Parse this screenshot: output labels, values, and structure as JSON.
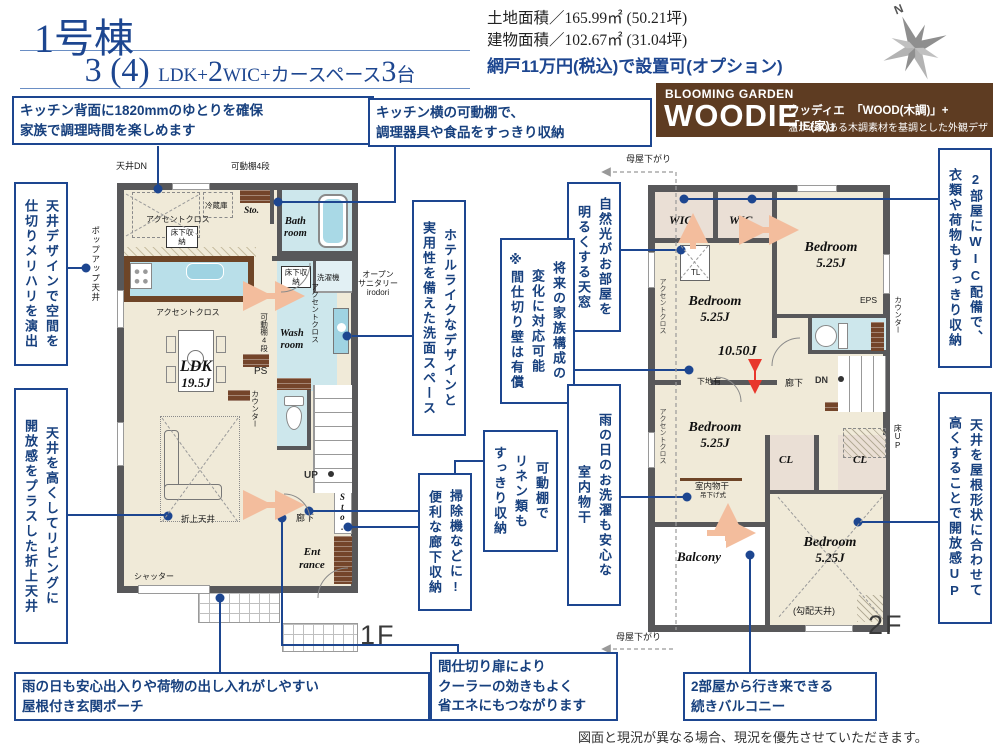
{
  "header": {
    "building_title": "1号棟",
    "layout_parts": [
      {
        "text": "3 (4) ",
        "size": "lg"
      },
      {
        "text": "LDK+",
        "size": "sm"
      },
      {
        "text": "2",
        "size": "lg"
      },
      {
        "text": "WIC+カースペース",
        "size": "sm"
      },
      {
        "text": "3",
        "size": "lg"
      },
      {
        "text": "台",
        "size": "sm"
      }
    ],
    "land_area": "土地面積／165.99㎡ (50.21坪)",
    "building_area": "建物面積／102.67㎡ (31.04坪)",
    "screen_note": "網戸11万円(税込)で設置可(オプション)",
    "compass_n": "N"
  },
  "brand": {
    "top": "BLOOMING GARDEN",
    "name": "WOODIE",
    "reading": "ウッディエ",
    "formula": "「WOOD(木調)」+「IE(家)」",
    "tagline": "温かみのある木調素材を基調とした外観デザイン"
  },
  "callouts": {
    "kitchen_back": {
      "lines": [
        "キッチン背面に1820mmのゆとりを確保",
        "家族で調理時間を楽しめます"
      ]
    },
    "kitchen_shelf": {
      "lines": [
        "キッチン横の可動棚で、",
        "調理器具や食品をすっきり収納"
      ]
    },
    "ceiling_design": {
      "cols": [
        "天井デザインで空間を",
        "仕切りメリハリを演出"
      ]
    },
    "folded_ceiling": {
      "cols": [
        "天井を高くしてリビングに",
        "開放感をプラスした折上天井"
      ]
    },
    "hotel_wash": {
      "cols": [
        "ホテルライクなデザインと",
        "実用性を備えた洗面スペース"
      ]
    },
    "skylight": {
      "cols": [
        "自然光がお部屋を",
        "明るくする天窓"
      ]
    },
    "future_family": {
      "cols": [
        "将来の家族構成の",
        "変化に対応可能",
        "※間仕切り壁は有償"
      ]
    },
    "indoor_drying": {
      "cols": [
        "雨の日のお洗濯も安心な",
        "室内物干"
      ]
    },
    "linen_shelf": {
      "cols": [
        "可動棚で",
        "リネン類も",
        "すっきり収納"
      ]
    },
    "hall_storage": {
      "cols": [
        "掃除機などに!",
        "便利な廊下収納"
      ]
    },
    "wic_rooms": {
      "cols": [
        "2部屋にWIC配備で、",
        "衣類や荷物もすっきり収納"
      ]
    },
    "sloped_ceiling": {
      "cols": [
        "天井を屋根形状に合わせて",
        "高くすることで開放感UP"
      ]
    },
    "porch": {
      "lines": [
        "雨の日も安心出入りや荷物の出し入れがしやすい",
        "屋根付き玄関ポーチ"
      ]
    },
    "partition_door": {
      "lines": [
        "間仕切り扉により",
        "クーラーの効きもよく",
        "省エネにもつながります"
      ]
    },
    "balcony2": {
      "lines": [
        "2部屋から行き来できる",
        "続きバルコニー"
      ]
    }
  },
  "plan1f": {
    "floor_label": "1F",
    "ceiling_dn": "天井DN",
    "movable_shelf_top": "可動棚4段",
    "fridge": "冷蔵庫",
    "sto_top": "Sto.",
    "bath_1": "Bath",
    "bath_2": "room",
    "accent_kitchen": "アクセントクロス",
    "underfloor": "床下収納",
    "popup_ceiling": "ポップアップ天井",
    "washer": "洗濯機",
    "wash_1": "Wash",
    "wash_2": "room",
    "accent_wash": "アクセントクロス",
    "open_san_1": "オープン",
    "open_san_2": "サニタリー",
    "open_san_3": "irodori",
    "movable_shelf_side": "可動棚4段",
    "ps": "PS",
    "counter": "カウンター",
    "accent_ldk": "アクセントクロス",
    "ldk_1": "LDK",
    "ldk_2": "19.5J",
    "up": "UP",
    "hallway": "廊下",
    "sto_hall": "Sto.",
    "ent_1": "Ent",
    "ent_2": "rance",
    "folded_ceiling": "折上天井",
    "shutter": "シャッター"
  },
  "plan2f": {
    "floor_label": "2F",
    "moya_top": "母屋下がり",
    "moya_bottom": "母屋下がり",
    "wic1": "WIC",
    "wic2": "WIC",
    "tl": "TL",
    "bed1_1": "Bedroom",
    "bed1_2": "5.25J",
    "bed2_1": "Bedroom",
    "bed2_2": "5.25J",
    "bed3_1": "Bedroom",
    "bed3_2": "5.25J",
    "bed4_1": "Bedroom",
    "bed4_2": "5.25J",
    "total_j": "10.50J",
    "shitaji": "下地有",
    "accent_1": "アクセントクロス",
    "accent_2": "アクセントクロス",
    "eps": "EPS",
    "counter": "カウンター",
    "dn": "DN",
    "hallway": "廊下",
    "floor_up": "床UP",
    "cl1": "CL",
    "cl2": "CL",
    "indoor_dry": "室内物干",
    "indoor_dry_sub": "吊下げ式",
    "balcony": "Balcony",
    "sloped": "(勾配天井)"
  },
  "footer": {
    "disclaimer": "図面と現況が異なる場合、現況を優先させていただきます。"
  },
  "colors": {
    "accent_blue": "#1d4690",
    "brand_brown": "#5e3c22",
    "floor_beige": "#f0ead8",
    "wet_blue": "#cde7ec",
    "wood_brown": "#74452a",
    "wall_gray": "#58585a",
    "arrow_orange": "#f3bd9d",
    "arrow_red": "#e8372c"
  }
}
